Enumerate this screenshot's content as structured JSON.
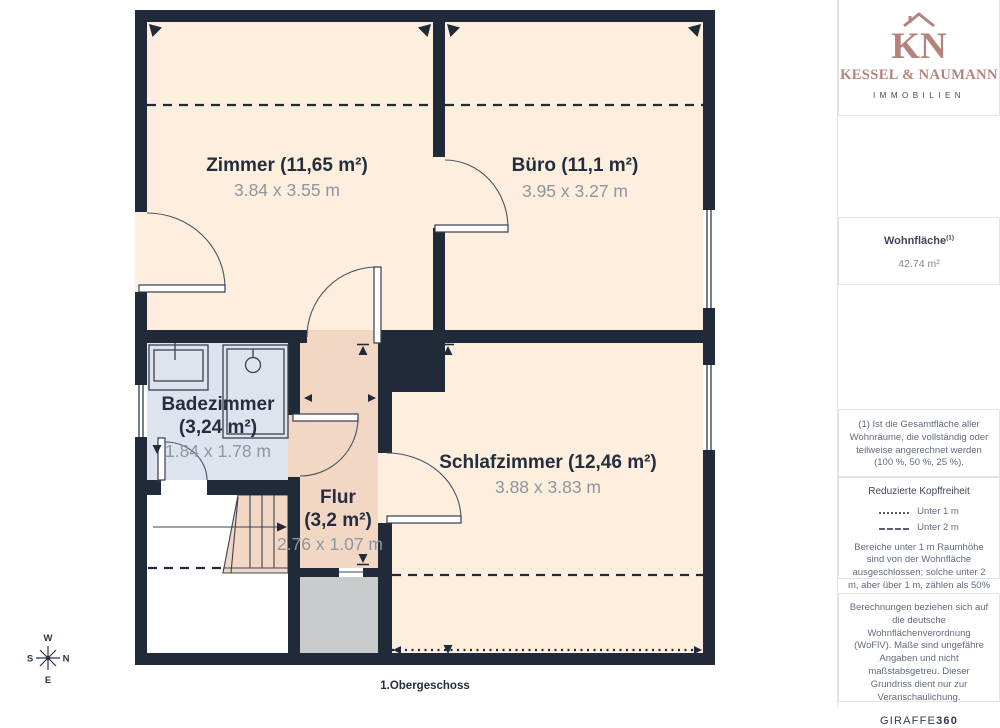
{
  "colors": {
    "wall": "#202a38",
    "room": "#fdeedd",
    "hall": "#f2d7c4",
    "bath": "#dfe3ee",
    "shaft": "#c9cbcd",
    "text_dark": "#242e3e",
    "text_dim": "#8d95a3",
    "accent": "#b5837c",
    "sidebar_text": "#5f6b7e",
    "sidebar_title": "#3c485a",
    "border": "#e4e4e4"
  },
  "branding": {
    "monogram": "KN",
    "company": "KESSEL & NAUMANN",
    "tagline": "IMMOBILIEN"
  },
  "sidebar": {
    "area_label": "Wohnfläche",
    "area_superscript": "(1)",
    "area_value": "42.74 m²",
    "note1": "(1) Ist die Gesamtfläche aller Wohnräume, die vollständig oder teilweise angerechnet werden (100 %, 50 %, 25 %).",
    "headroom": {
      "title": "Reduzierte Kopffreiheit",
      "legend": [
        {
          "style": "dotted",
          "label": "Unter 1 m"
        },
        {
          "style": "dashed",
          "label": "Unter 2 m"
        }
      ],
      "note": "Bereiche unter 1 m Raumhöhe sind von der Wohnfläche ausgeschlossen; solche unter 2 m, aber über 1 m, zählen als 50% der Wohnfläche"
    },
    "disclaimer": "Berechnungen beziehen sich auf die deutsche Wohnflächenverordnung (WoFlV). Maße sind ungefähre Angaben und nicht maßstabsgetreu. Dieser Grundriss dient nur zur Veranschaulichung.",
    "brand_footer_name": "GIRAFFE",
    "brand_footer_suffix": "360"
  },
  "floorplan": {
    "caption": "1.Obergeschoss",
    "rooms": [
      {
        "id": "zimmer",
        "name": "Zimmer (11,65 m²)",
        "dimensions": "3.84 x 3.55 m"
      },
      {
        "id": "buero",
        "name": "Büro (11,1 m²)",
        "dimensions": "3.95 x 3.27 m"
      },
      {
        "id": "badezimmer",
        "name": "Badezimmer",
        "name_line2": "(3,24 m²)",
        "dimensions": "1.84 x 1.78 m"
      },
      {
        "id": "schlafzimmer",
        "name": "Schlafzimmer (12,46 m²)",
        "dimensions": "3.88 x 3.83 m"
      },
      {
        "id": "flur",
        "name": "Flur",
        "name_line2": "(3,2 m²)",
        "dimensions": "2.76 x 1.07 m"
      }
    ],
    "compass": {
      "top": "W",
      "right": "N",
      "bottom": "E",
      "left": "S"
    }
  }
}
